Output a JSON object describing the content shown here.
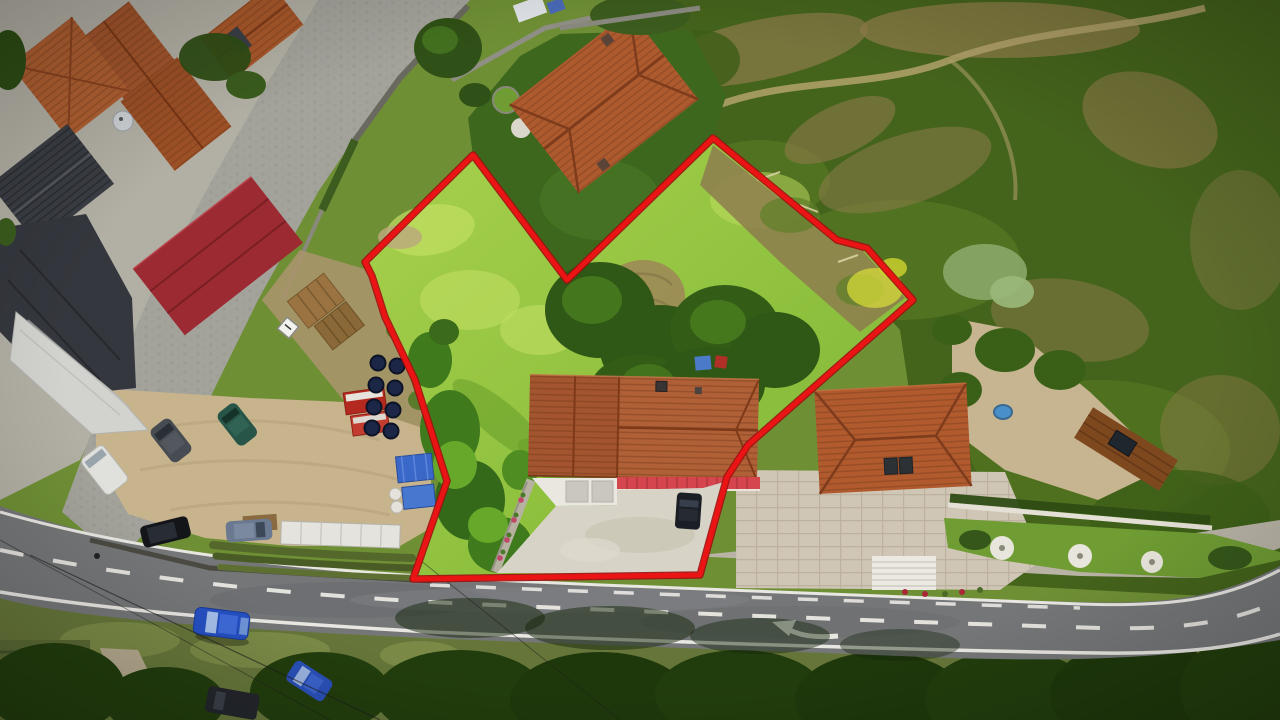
{
  "scene": {
    "type": "aerial-drone-photograph",
    "description": "Top-down drone photo of a building plot for sale outlined with a red boundary line, surrounded by village houses, a main road with markings, parking areas and fields",
    "image_size": {
      "width": 1280,
      "height": 720
    }
  },
  "boundary": {
    "color": "#ea1414",
    "shadow_color": "#9c1010",
    "stroke_width": 5,
    "points": "473,155 567,280 713,138 837,240 867,248 913,300 748,445 727,477 700,575 413,579 447,481 415,380 385,317 372,276 365,262"
  },
  "palette": {
    "meadow_bright": "#a8d14c",
    "meadow_deep": "#7cb535",
    "field_dark_green": "#44631b",
    "field_brown": "#8d7c4a",
    "forest_dark": "#223d0d",
    "asphalt": "#747678",
    "road_marking_white": "#e9e8e3",
    "cobble_gray": "#a3a39b",
    "sand_parking": "#c7b48d",
    "roof_orange": "#b06036",
    "roof_dark_slate": "#3a3d43",
    "roof_crimson_metal": "#9c2a32",
    "canopy_red": "#d4454e",
    "driveway_concrete": "#d7d3c6"
  },
  "road": {
    "type": "two-lane asphalt road, lower part of image, running left to bottom-right then curving up at far right",
    "center_line": "dashed white",
    "edge_lines": "solid white",
    "marking_arrow": "white left-turn arrow in right lane",
    "cobbled_lane": "light gray cobbled lane curving from top edge down to the left"
  },
  "objects": {
    "buildings": [
      {
        "id": "subject-house",
        "roof": "orange tile",
        "extras": "red metal canopy strip, white garage, concrete driveway",
        "location": "bottom-center inside red boundary"
      },
      {
        "id": "north-neighbor-house",
        "roof": "orange tile",
        "extras": "dark lawn filling the V-notch of the boundary",
        "location": "top-center"
      },
      {
        "id": "east-neighbor-house",
        "roof": "orange hip tile with dark skylights",
        "extras": "paver patio, white stairs, gravel court, small pond, lawn with white circles",
        "location": "right of plot"
      },
      {
        "id": "east-outbuilding",
        "roof": "brown tile with solar panel",
        "location": "far right of east neighbor"
      },
      {
        "id": "northwest-house-cluster",
        "roof": "four orange tile roofs, satellite dish",
        "location": "top-left"
      },
      {
        "id": "dark-slate-house",
        "roof": "dark slate hip",
        "location": "left edge"
      },
      {
        "id": "dark-warehouse",
        "roof": "dark tiles with long silver awning",
        "location": "left edge, lower"
      },
      {
        "id": "crimson-barn",
        "roof": "crimson corrugated metal",
        "location": "upper left"
      }
    ],
    "vehicles": [
      {
        "id": "white-van",
        "color": "#e0e0dc",
        "location": "sand parking"
      },
      {
        "id": "dark-gray-car",
        "color": "#474b52",
        "location": "sand parking"
      },
      {
        "id": "teal-car",
        "color": "#275548",
        "location": "sand parking"
      },
      {
        "id": "black-car",
        "color": "#131519",
        "location": "sand parking lower row"
      },
      {
        "id": "gray-blue-car",
        "color": "#6a7890",
        "location": "sand parking lower row"
      },
      {
        "id": "white-box-trailer",
        "color": "#e4e3dd",
        "location": "below parking"
      },
      {
        "id": "red-truck-trailers",
        "color": "#b3291f",
        "location": "along left boundary"
      },
      {
        "id": "dark-storage-tanks",
        "color": "#1c2747",
        "count": 8,
        "location": "along left boundary"
      },
      {
        "id": "blue-tarp-stacks",
        "color": "#3a68c8",
        "location": "along left boundary"
      },
      {
        "id": "blue-car-driving",
        "color": "#2550c2",
        "location": "on main road"
      },
      {
        "id": "blue-car-parked",
        "color": "#2a50b8",
        "location": "bottom lane"
      },
      {
        "id": "dark-van-parked",
        "color": "#23262b",
        "location": "bottom lane"
      },
      {
        "id": "black-car-driveway",
        "color": "#1b1e24",
        "location": "subject house driveway"
      }
    ],
    "vegetation": [
      {
        "id": "plot-meadow",
        "desc": "bright yellow-green grass with dry brown patch and central tree clump"
      },
      {
        "id": "scrub-field",
        "desc": "large dark green field with brown dry patches and a dirt trail, upper right"
      },
      {
        "id": "roadside-forest",
        "desc": "dark tree canopy below the road casting shadows onto the asphalt"
      },
      {
        "id": "terraced-garden-rows",
        "desc": "crop rows between parking and road"
      }
    ],
    "markings": [
      {
        "id": "white-diamond-sign",
        "location": "on cobbled lane"
      },
      {
        "id": "wooden-pallets",
        "location": "dirt area left of plot"
      }
    ]
  }
}
